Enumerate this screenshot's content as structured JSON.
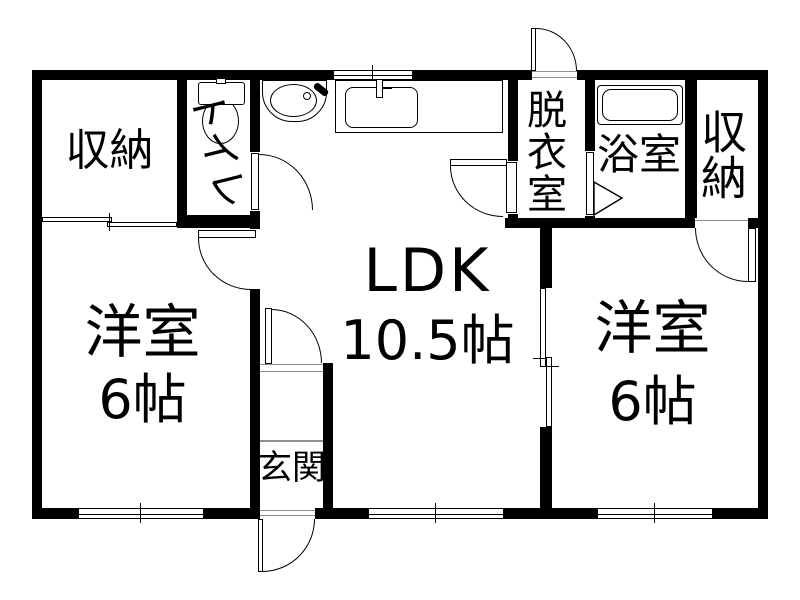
{
  "plan": {
    "type": "apartment-floor-plan",
    "rooms": {
      "closet_left": {
        "label": "収納"
      },
      "toilet": {
        "label": "トイレ"
      },
      "ldk": {
        "label": "LDK",
        "area": "10.5帖"
      },
      "dressing_room": {
        "label": "脱衣室"
      },
      "bathroom": {
        "label": "浴室"
      },
      "closet_right": {
        "label": "収納"
      },
      "bedroom_left": {
        "label": "洋室",
        "area": "6帖"
      },
      "bedroom_right": {
        "label": "洋室",
        "area": "6帖"
      },
      "entrance": {
        "label": "玄関"
      }
    },
    "fixtures": {
      "toilet": "toilet-top-view-icon",
      "washbasin": "washbasin-top-view-icon",
      "kitchen_sink": "kitchen-counter-sink-icon",
      "bathtub": "bathtub-top-view-icon"
    },
    "colors": {
      "wall": "#000000",
      "background": "#ffffff",
      "detail_line": "#8f8f8f"
    }
  }
}
